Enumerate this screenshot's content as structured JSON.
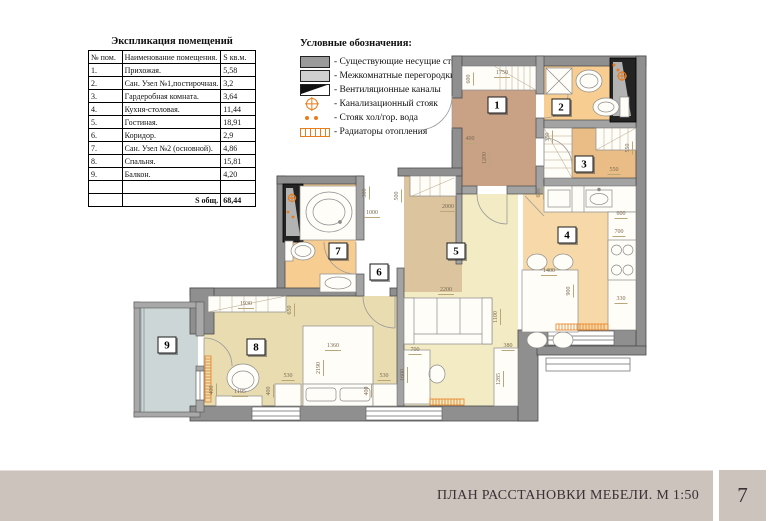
{
  "schedule_table": {
    "title": "Экспликация помещений",
    "columns": [
      "№ пом.",
      "Наименование помещения.",
      "S кв.м."
    ],
    "rows": [
      [
        "1.",
        "Прихожая.",
        "5,58"
      ],
      [
        "2.",
        "Сан. Узел №1,постирочная.",
        "3,2"
      ],
      [
        "3.",
        "Гардеробная комната.",
        "3,64"
      ],
      [
        "4.",
        "Кухня-столовая.",
        "11,44"
      ],
      [
        "5.",
        "Гостиная.",
        "18,91"
      ],
      [
        "6.",
        "Коридор.",
        "2,9"
      ],
      [
        "7.",
        "Сан. Узел №2 (основной).",
        "4,86"
      ],
      [
        "8.",
        "Спальня.",
        "15,81"
      ],
      [
        "9.",
        "Балкон.",
        "4,20"
      ],
      [
        "",
        "",
        ""
      ]
    ],
    "total_label": "S общ.",
    "total_value": "68,44"
  },
  "legend": {
    "title": "Условные обозначения:",
    "items": [
      {
        "symbol": "bearing-wall",
        "label": "- Существующие несущие стены"
      },
      {
        "symbol": "partition",
        "label": "- Межкомнатные перегородки"
      },
      {
        "symbol": "vent-channel",
        "label": "- Вентиляционные каналы"
      },
      {
        "symbol": "sewer-riser",
        "label": "- Канализационный стояк"
      },
      {
        "symbol": "water-riser",
        "label": "- Стояк хол/гор. вода"
      },
      {
        "symbol": "radiator",
        "label": "- Радиаторы отопления"
      }
    ]
  },
  "plan": {
    "room_labels": [
      {
        "n": "1",
        "x": 497,
        "y": 105
      },
      {
        "n": "2",
        "x": 561,
        "y": 107
      },
      {
        "n": "3",
        "x": 584,
        "y": 164
      },
      {
        "n": "4",
        "x": 567,
        "y": 235
      },
      {
        "n": "5",
        "x": 456,
        "y": 251
      },
      {
        "n": "6",
        "x": 379,
        "y": 272
      },
      {
        "n": "7",
        "x": 338,
        "y": 251
      },
      {
        "n": "8",
        "x": 256,
        "y": 347
      },
      {
        "n": "9",
        "x": 167,
        "y": 345
      }
    ],
    "dimensions": [
      {
        "t": "600",
        "x": 470,
        "y": 79,
        "r": "v"
      },
      {
        "t": "1750",
        "x": 502,
        "y": 74,
        "r": "h"
      },
      {
        "t": "400",
        "x": 470,
        "y": 140,
        "r": "h"
      },
      {
        "t": "1200",
        "x": 486,
        "y": 158,
        "r": "v"
      },
      {
        "t": "350",
        "x": 549,
        "y": 137,
        "r": "v"
      },
      {
        "t": "550",
        "x": 614,
        "y": 171,
        "r": "h"
      },
      {
        "t": "550",
        "x": 629,
        "y": 148,
        "r": "v"
      },
      {
        "t": "600",
        "x": 540,
        "y": 193,
        "r": "v"
      },
      {
        "t": "600",
        "x": 621,
        "y": 215,
        "r": "h"
      },
      {
        "t": "700",
        "x": 619,
        "y": 233,
        "r": "h"
      },
      {
        "t": "330",
        "x": 621,
        "y": 300,
        "r": "h"
      },
      {
        "t": "2000",
        "x": 448,
        "y": 208,
        "r": "h"
      },
      {
        "t": "500",
        "x": 398,
        "y": 196,
        "r": "v"
      },
      {
        "t": "300",
        "x": 366,
        "y": 193,
        "r": "v"
      },
      {
        "t": "1000",
        "x": 372,
        "y": 214,
        "r": "h"
      },
      {
        "t": "1400",
        "x": 549,
        "y": 272,
        "r": "h"
      },
      {
        "t": "900",
        "x": 570,
        "y": 291,
        "r": "v"
      },
      {
        "t": "2200",
        "x": 446,
        "y": 291,
        "r": "h"
      },
      {
        "t": "1100",
        "x": 497,
        "y": 317,
        "r": "v"
      },
      {
        "t": "700",
        "x": 415,
        "y": 351,
        "r": "h"
      },
      {
        "t": "1600",
        "x": 404,
        "y": 375,
        "r": "v"
      },
      {
        "t": "380",
        "x": 508,
        "y": 347,
        "r": "h"
      },
      {
        "t": "1285",
        "x": 500,
        "y": 379,
        "r": "v"
      },
      {
        "t": "1930",
        "x": 246,
        "y": 305,
        "r": "h"
      },
      {
        "t": "650",
        "x": 291,
        "y": 310,
        "r": "v"
      },
      {
        "t": "1360",
        "x": 333,
        "y": 347,
        "r": "h"
      },
      {
        "t": "2190",
        "x": 320,
        "y": 368,
        "r": "v"
      },
      {
        "t": "530",
        "x": 288,
        "y": 377,
        "r": "h"
      },
      {
        "t": "400",
        "x": 270,
        "y": 391,
        "r": "v"
      },
      {
        "t": "530",
        "x": 384,
        "y": 377,
        "r": "h"
      },
      {
        "t": "400",
        "x": 368,
        "y": 391,
        "r": "v"
      },
      {
        "t": "1195",
        "x": 240,
        "y": 393,
        "r": "h"
      },
      {
        "t": "400",
        "x": 213,
        "y": 390,
        "r": "v"
      }
    ]
  },
  "footer": {
    "title": "ПЛАН РАССТАНОВКИ МЕБЕЛИ. М 1:50",
    "page_number": "7"
  },
  "colors": {
    "accent_orange": "#e87d1e",
    "wall_gray": "#8f8f8f",
    "footer_bar": "#cbc3bc",
    "room_hallway": "#c9a185",
    "room_bath": "#f7cd92",
    "room_wardrobe": "#e9bd85",
    "room_kitchen": "#f7d9a9",
    "room_living": "#f3ebc4",
    "room_corridor": "#dbc49e",
    "room_bedroom": "#e8dcb0",
    "room_balcony": "#ccd6d6"
  }
}
